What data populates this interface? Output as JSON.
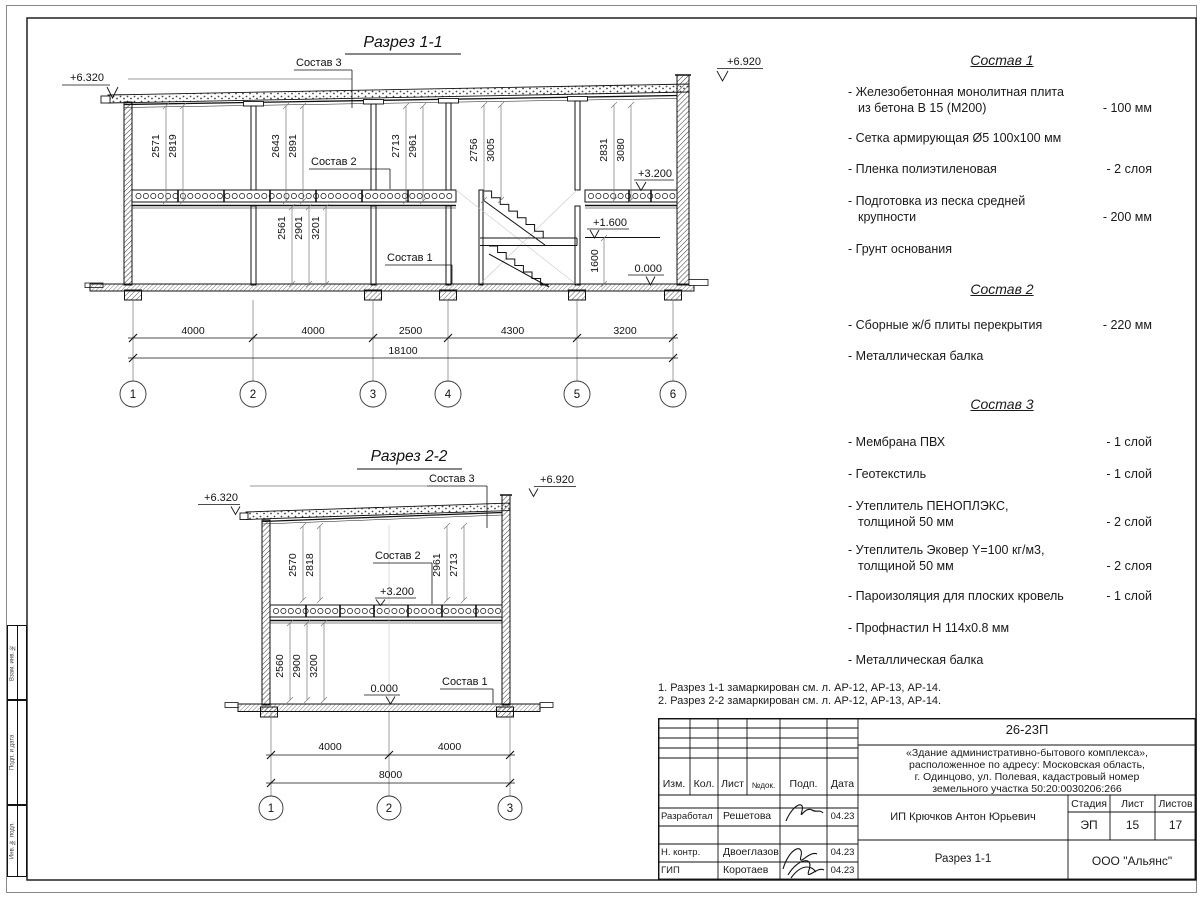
{
  "section1": {
    "title": "Разрез 1-1",
    "elev_left": "+6.320",
    "elev_right": "+6.920",
    "elev_floor": "+3.200",
    "elev_landing": "+1.600",
    "elev_zero": "0.000",
    "dim_landing": "1600",
    "label_sostav1": "Состав 1",
    "label_sostav2": "Состав 2",
    "label_sostav3": "Состав 3",
    "du": [
      "2571",
      "2819",
      "2643",
      "2891",
      "2713",
      "2961",
      "2756",
      "3005",
      "2831",
      "3080"
    ],
    "dl": [
      "2561",
      "2901",
      "3201"
    ],
    "db": [
      "4000",
      "4000",
      "2500",
      "4300",
      "3200"
    ],
    "total": "18100",
    "axes": [
      "1",
      "2",
      "3",
      "4",
      "5",
      "6"
    ]
  },
  "section2": {
    "title": "Разрез 2-2",
    "elev_left": "+6.320",
    "elev_right": "+6.920",
    "elev_floor": "+3.200",
    "elev_zero": "0.000",
    "label_sostav1": "Состав 1",
    "label_sostav2": "Состав 2",
    "label_sostav3": "Состав 3",
    "du": [
      "2570",
      "2818",
      "2961",
      "2713"
    ],
    "dl": [
      "2560",
      "2900",
      "3200"
    ],
    "db": [
      "4000",
      "4000"
    ],
    "total": "8000",
    "axes": [
      "1",
      "2",
      "3"
    ]
  },
  "comps": [
    {
      "title": "Состав 1",
      "items": [
        {
          "l1": "- Железобетонная  монолитная плита",
          "l2": "из бетона В 15 (М200)",
          "v": "- 100 мм"
        },
        {
          "l1": "- Сетка армирующая Ø5 100х100 мм"
        },
        {
          "l1": "- Пленка полиэтиленовая",
          "v": "-  2 слоя"
        },
        {
          "l1": "- Подготовка из песка средней",
          "l2": "крупности",
          "v": "- 200 мм"
        },
        {
          "l1": "- Грунт основания"
        }
      ]
    },
    {
      "title": "Состав 2",
      "items": [
        {
          "l1": "- Сборные ж/б плиты перекрытия",
          "v": "- 220 мм"
        },
        {
          "l1": "- Металлическая балка"
        }
      ]
    },
    {
      "title": "Состав 3",
      "items": [
        {
          "l1": "- Мембрана ПВХ",
          "v": "- 1 слой"
        },
        {
          "l1": "- Геотекстиль",
          "v": "- 1 слой"
        },
        {
          "l1": "- Утеплитель ПЕНОПЛЭКС,",
          "l2": "толщиной 50 мм",
          "v": "- 2 слой"
        },
        {
          "l1": "- Утеплитель Эковер Y=100 кг/м3,",
          "l2": "толщиной 50 мм",
          "v": "- 2 слоя"
        },
        {
          "l1": "- Пароизоляция для плоских кровель",
          "v": "- 1 слой"
        },
        {
          "l1": "- Профнастил Н 114х0.8 мм"
        },
        {
          "l1": "- Металлическая балка"
        }
      ]
    }
  ],
  "notes": [
    "1. Разрез 1-1 замаркирован см. л. АР-12, АР-13, АР-14.",
    "2. Разрез 2-2 замаркирован см. л. АР-12, АР-13, АР-14."
  ],
  "tb": {
    "code": "26-23П",
    "desc1": "«Здание административно-бытового комплекса»,",
    "desc2": "расположенное по адресу: Московская область,",
    "desc3": "г. Одинцово, ул. Полевая, кадастровый номер",
    "desc4": "земельного участка 50:20:0030206:266",
    "h_izm": "Изм.",
    "h_kol": "Кол.",
    "h_list": "Лист",
    "h_ndok": "№док.",
    "h_podp": "Подп.",
    "h_data": "Дата",
    "r1_role": "Разработал",
    "r1_name": "Решетова",
    "r1_date": "04.23",
    "r2_role": "Н. контр.",
    "r2_name": "Двоеглазов",
    "r2_date": "04.23",
    "r3_role": "ГИП",
    "r3_name": "Коротаев",
    "r3_date": "04.23",
    "org": "ИП Крючков Антон Юрьевич",
    "sheet_title": "Разрез 1-1",
    "h_stage": "Стадия",
    "h_sheet": "Лист",
    "h_sheets": "Листов",
    "stage": "ЭП",
    "sheet": "15",
    "sheets": "17",
    "company": "ООО \"Альянс\""
  },
  "sidebar": [
    "Взам. инв. №",
    "Подп. и дата",
    "Инв. № подл."
  ]
}
